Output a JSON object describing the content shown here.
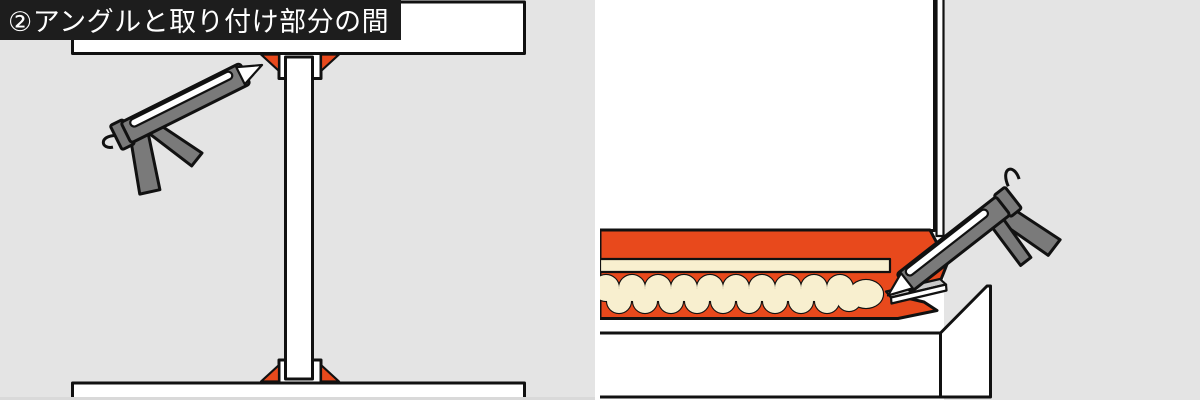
{
  "label": {
    "text": "②アングルと取り付け部分の間"
  },
  "colors": {
    "background_gray": "#e4e4e4",
    "panel_white": "#ffffff",
    "outline_black": "#111111",
    "accent_orange": "#e8491c",
    "sealant_cream": "#f8efcf",
    "gun_gray": "#7a7a7a",
    "angle_gray": "#c9c9c9",
    "bottom_edge_gray": "#d9d9d9",
    "label_bg": "#1d1d1d",
    "label_text": "#ffffff"
  }
}
